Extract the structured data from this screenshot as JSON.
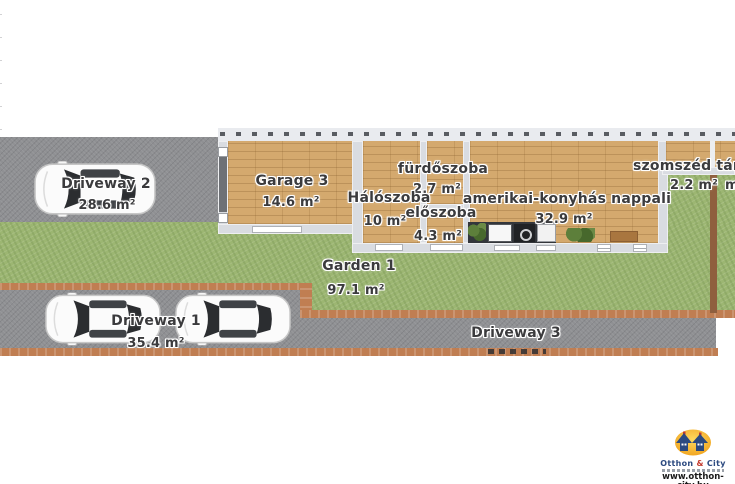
{
  "areas": {
    "driveway2": {
      "name": "Driveway 2",
      "area": "28.6 m²"
    },
    "garage3": {
      "name": "Garage 3",
      "area": "14.6 m²"
    },
    "furdoszoba": {
      "name": "fürdőszoba",
      "area": "2.7 m²"
    },
    "haloszoba": {
      "name": "Hálószoba",
      "area": "10 m²"
    },
    "eloszoba": {
      "name": "előszoba",
      "area": "4.3 m²"
    },
    "nappali": {
      "name": "amerikai-konyhás nappali",
      "area": "32.9 m²"
    },
    "szomszed_tarolo": {
      "name": "szomszéd táro",
      "area": "2.2 m²",
      "area2_partial": "m"
    },
    "garden1": {
      "name": "Garden 1",
      "area": "97.1 m²"
    },
    "driveway1": {
      "name": "Driveway 1",
      "area": "35.4 m²"
    },
    "driveway3": {
      "name": "Driveway 3"
    }
  },
  "logo": {
    "brand_otthon": "Otthon",
    "brand_amp": "&",
    "brand_city": "City",
    "url": "www.otthon-city.hu"
  },
  "colors": {
    "grass": "#9cb672",
    "road": "#8f9093",
    "wood_floor": "#d4a96e",
    "wall": "#d9dce1",
    "fence": "#c07e52",
    "fence_post": "#8f5f3e",
    "label_text": "#3b3b3d",
    "kitchen_counter": "#33363b",
    "logo_orange": "#efa01c",
    "logo_blue": "#2c4a80",
    "logo_red": "#c43b2e"
  }
}
